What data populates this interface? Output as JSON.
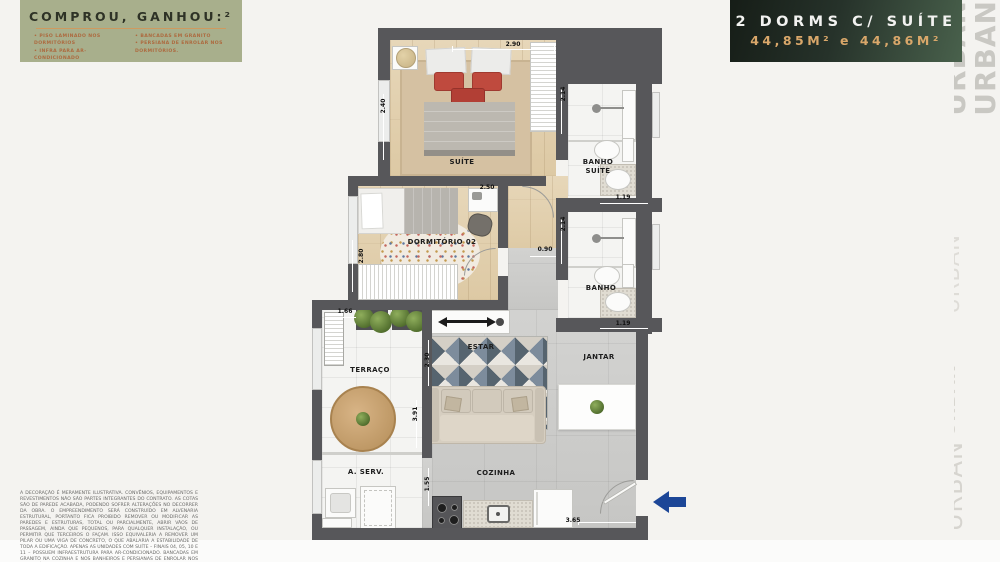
{
  "promo": {
    "title": "COMPROU, GANHOU:²",
    "bullets_left": [
      "• PISO LAMINADO NOS DORMITÓRIOS",
      "• INFRA PARA AR-CONDICIONADO"
    ],
    "bullets_right": [
      "• BANCADAS EM GRANITO",
      "• PERSIANA DE ENROLAR NOS DORMITÓRIOS."
    ]
  },
  "unit_badge": {
    "title": "2 DORMS C/ SUÍTE",
    "area": "44,85M² e 44,86M²"
  },
  "watermark": {
    "word": "URBAN"
  },
  "colors": {
    "promo_green": "#a8af8c",
    "badge_gold": "#d9a76a",
    "wall_gray": "#57575a",
    "entry_arrow_blue": "#1c4697"
  },
  "floorplan": {
    "rooms": {
      "suite": "SUÍTE",
      "banho_suite_l1": "BANHO",
      "banho_suite_l2": "SUÍTE",
      "dormitorio2": "DORMITÓRIO 02",
      "banho": "BANHO",
      "estar": "ESTAR",
      "jantar": "JANTAR",
      "terraco": "TERRAÇO",
      "aserv": "A. SERV.",
      "cozinha": "COZINHA"
    },
    "dimensions": {
      "suite_width": "2.90",
      "suite_depth": "2.40",
      "banho_suite_depth": "2.14",
      "banho_suite_width": "1.19",
      "dorm2_width": "2.50",
      "dorm2_depth": "2.80",
      "banho_depth": "2.14",
      "banho_width": "1.19",
      "hall_width": "0.90",
      "terraco_width": "1.66",
      "estar_width": "2.30",
      "estar_depth": "3.91",
      "cozinha_depth": "1.55",
      "cozinha_width": "3.65"
    }
  },
  "disclaimer": "A DECORAÇÃO É MERAMENTE ILUSTRATIVA. CONVÊNIOS, EQUIPAMENTOS E REVESTIMENTOS NÃO SÃO PARTES INTEGRANTES DO CONTRATO. AS COTAS SÃO DE PAREDE ACABADA, PODENDO SOFRER ALTERAÇÕES NO DECORRER DA OBRA. O EMPREENDIMENTO SERÁ CONSTRUÍDO EM ALVENARIA ESTRUTURAL, PORTANTO FICA PROIBIDO REMOVER OU MODIFICAR AS PAREDES E ESTRUTURAS, TOTAL OU PARCIALMENTE, ABRIR VÃOS DE PASSAGEM, AINDA QUE PEQUENOS, PARA QUALQUER INSTALAÇÃO, OU PERMITIR QUE TERCEIROS O FAÇAM. ISSO EQUIVALERIA A REMOVER UM PILAR OU UMA VIGA DE CONCRETO, O QUE ABALARIA A ESTABILIDADE DE TODA A EDIFICAÇÃO. APENAS AS UNIDADES COM SUÍTE – FINAIS 04, 05, 10 E 11 – POSSUEM INFRAESTRUTURA PARA AR-CONDICIONADO. BANCADAS EM GRANITO NA COZINHA E NOS BANHEIROS E PERSIANAS DE ENROLAR NOS DORMITÓRIOS. CONSULTE O MEMORIAL DESCRITIVO DO CLIENTE PARA MAIS INFORMAÇÕES."
}
